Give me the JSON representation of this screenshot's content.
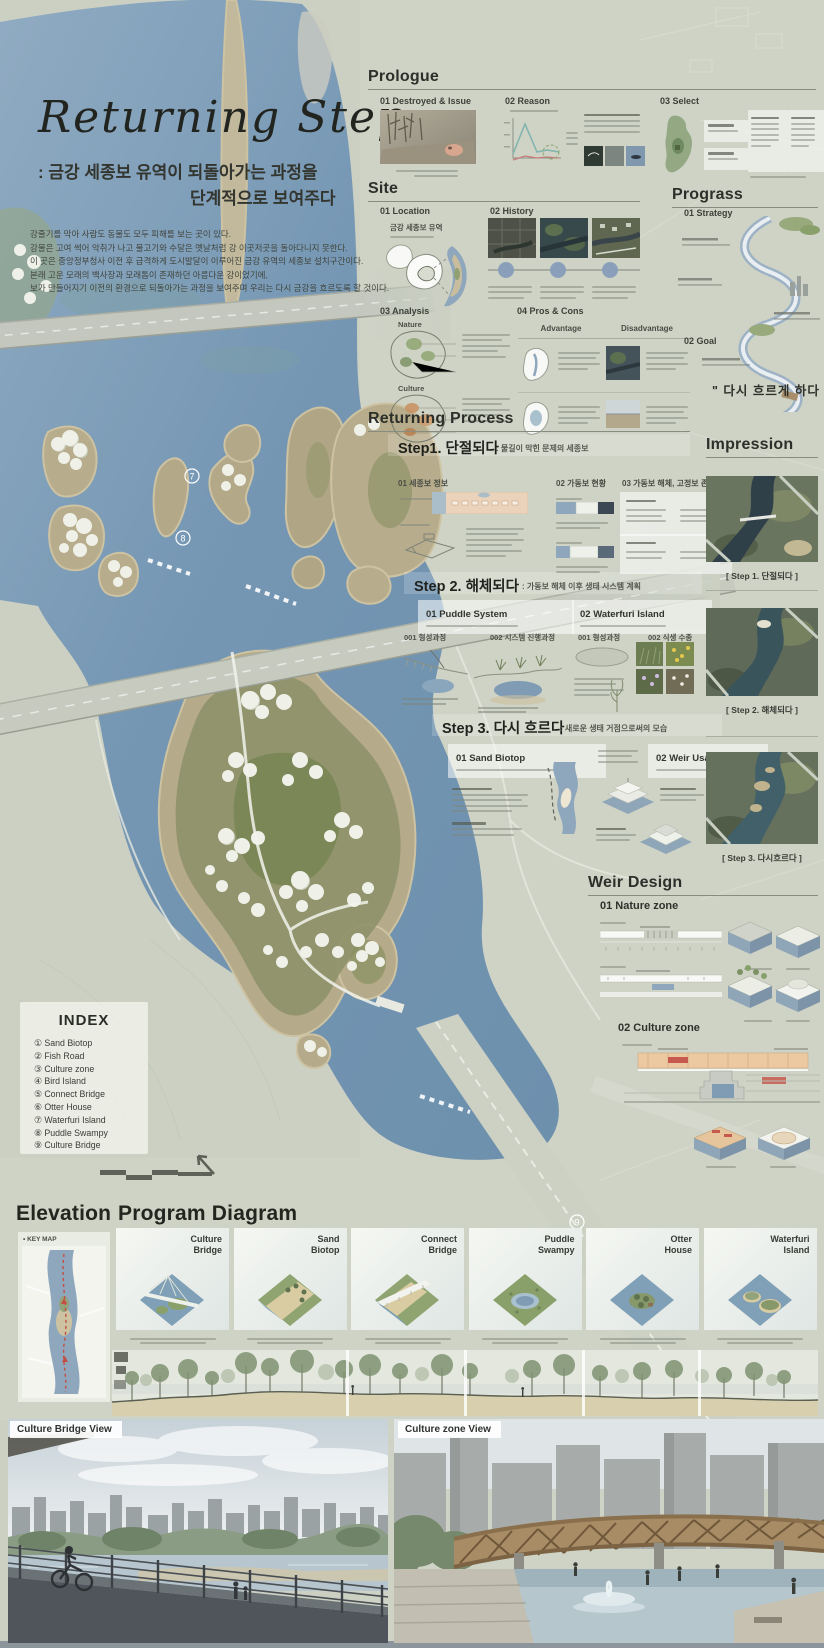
{
  "poster": {
    "title": "Returning Step",
    "subtitle1": ": 금강 세종보 유역이 되돌아가는 과정을",
    "subtitle2": "단계적으로 보여주다",
    "intro_lines": [
      "강줄기를 막아 사람도 동물도 모두 피해를 보는 곳이 있다.",
      "강물은 고여 썩어 악취가 나고 물고기와 수달은 옛날처럼 강 이곳저곳을 돌아다니지 못한다.",
      "이 곳은 중앙정부청사 이전 후 급격하게 도시발달이 이루어진 금강 유역의 세종보 설치구간이다.",
      "본래 고운 모래의 백사장과 모래톱이 존재하던 아름다운 강이었기에,",
      "보가 만들어지기 이전의 환경으로 되돌아가는 과정을 보여주며 우리는 다시 금강을 흐르도록 할 것이다."
    ]
  },
  "prologue": {
    "title": "Prologue",
    "item1": "01 Destroyed & Issue",
    "item2": "02 Reason",
    "item3": "03 Select"
  },
  "site": {
    "title": "Site",
    "item1": "01 Location",
    "item2": "02 History",
    "item3": "03 Analysis",
    "item4": "04 Pros & Cons",
    "location_label": "금강 세종보 유역",
    "nature": "Nature",
    "culture": "Culture",
    "advantage": "Advantage",
    "disadvantage": "Disadvantage"
  },
  "progress": {
    "title": "Prograss",
    "item1": "01 Strategy",
    "item2": "02 Goal",
    "quote": "\" 다시 흐르게 하다 \""
  },
  "process": {
    "title": "Returning Process",
    "step1": {
      "label": "Step1. 단절되다",
      "desc": ": 물길이 막힌 문제의 세종보",
      "col1": "01 세종보 정보",
      "col2": "02 가동보 현황",
      "col3": "03 가동보 해체, 고정보 존치"
    },
    "step2": {
      "label": "Step 2. 해체되다",
      "desc": ": 가동보 해체 이후 생태 시스템 계획",
      "box1": "01 Puddle System",
      "box1_item1": "001 형성과정",
      "box1_item2": "002 시스템 진행과정",
      "box2": "02 Waterfuri Island",
      "box2_item1": "001 형성과정",
      "box2_item2": "002 식생 수종"
    },
    "step3": {
      "label": "Step 3. 다시 흐르다",
      "desc": ": 새로운 생태 거점으로써의 모습",
      "box1": "01 Sand Biotop",
      "box2": "02 Weir Usability"
    }
  },
  "impression": {
    "title": "Impression",
    "cap1": "[ Step 1. 단절되다 ]",
    "cap2": "[ Step 2. 해체되다 ]",
    "cap3": "[ Step 3. 다시흐르다 ]"
  },
  "weir": {
    "title": "Weir Design",
    "zone1": "01 Nature zone",
    "zone2": "02 Culture zone"
  },
  "index": {
    "title": "INDEX",
    "items": [
      "① Sand Biotop",
      "② Fish Road",
      "③ Culture zone",
      "④ Bird Island",
      "⑤ Connect Bridge",
      "⑥ Otter House",
      "⑦ Waterfuri Island",
      "⑧ Puddle Swampy",
      "⑨ Culture Bridge"
    ]
  },
  "map": {
    "marker7": "7",
    "marker8": "8",
    "marker9": "9"
  },
  "bottom": {
    "elevation_title": "Elevation",
    "keymap_label": "• KEY MAP",
    "program_title": "Program Diagram",
    "cards": [
      "Culture\nBridge",
      "Sand\nBiotop",
      "Connect\nBridge",
      "Puddle\nSwampy",
      "Otter\nHouse",
      "Waterfuri\nIsland"
    ]
  },
  "views": {
    "left": "Culture Bridge View",
    "right": "Culture zone View"
  }
}
